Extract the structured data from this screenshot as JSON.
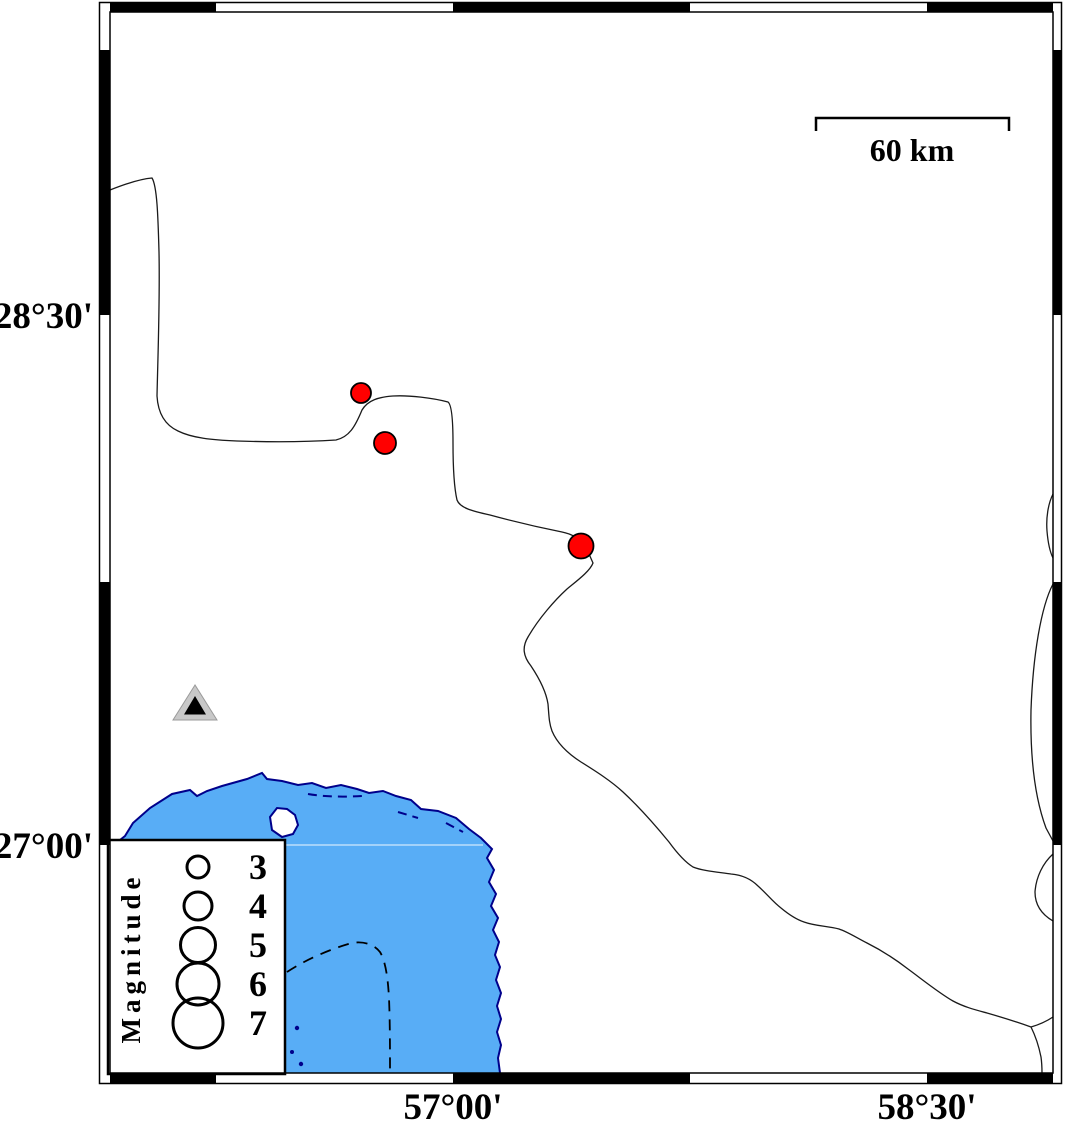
{
  "map": {
    "kind": "seismicity-map",
    "axis": {
      "lat_ticks": [
        {
          "label": "28°30'",
          "y_px": 315
        },
        {
          "label": "27°00'",
          "y_px": 845
        }
      ],
      "lon_ticks": [
        {
          "label": "57°00'",
          "x_px": 453
        },
        {
          "label": "58°30'",
          "x_px": 927
        }
      ]
    },
    "scale_bar": {
      "label": "60 km",
      "kilometers": 60
    },
    "legend": {
      "title": "Magnitude",
      "entries": [
        {
          "label": "3",
          "magnitude": 3,
          "r": 11
        },
        {
          "label": "4",
          "magnitude": 4,
          "r": 14
        },
        {
          "label": "5",
          "magnitude": 5,
          "r": 17.5
        },
        {
          "label": "6",
          "magnitude": 6,
          "r": 21
        },
        {
          "label": "7",
          "magnitude": 7,
          "r": 25
        }
      ]
    },
    "earthquakes": [
      {
        "x": 361,
        "y": 393,
        "r": 10
      },
      {
        "x": 385,
        "y": 443,
        "r": 11
      },
      {
        "x": 581,
        "y": 546,
        "r": 12.5
      }
    ],
    "station": {
      "x": 195,
      "y": 705
    },
    "colors": {
      "water": "#58ADF6",
      "coast_outline": "#00008B",
      "inland_line": "#1a1a1a",
      "earthquake": "#FF0000",
      "earthquake_stroke": "#000000",
      "station_fill": "#C8C8C8",
      "frame": "#000000"
    }
  }
}
